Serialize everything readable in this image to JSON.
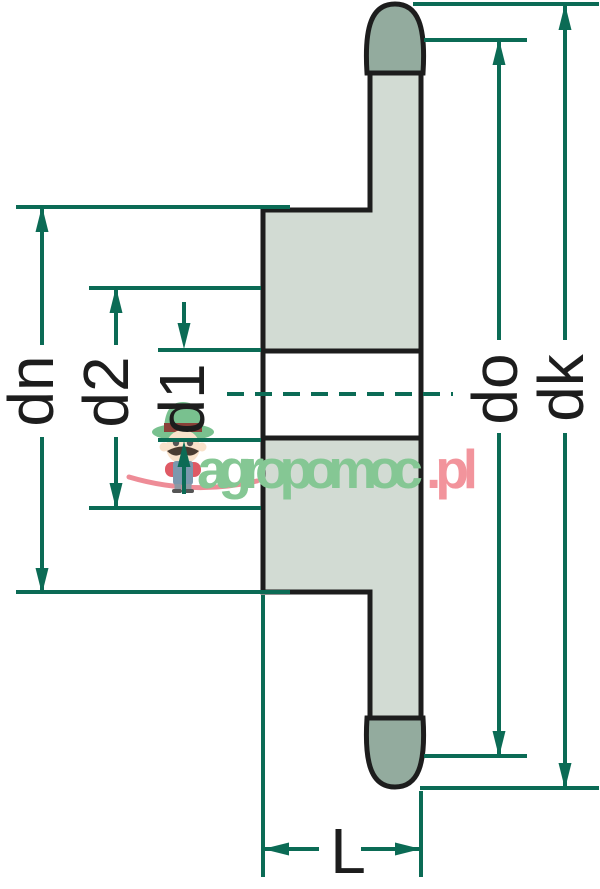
{
  "diagram": {
    "subject": "Sprocket cross-section dimension drawing",
    "dimension_labels": {
      "dn": "dn",
      "d2": "d2",
      "d1": "d1",
      "do": "do",
      "dk": "dk",
      "L": "L"
    },
    "watermark": {
      "brand_green": "agropomoc",
      "brand_pink": ".pl"
    },
    "colors": {
      "dimension_line": "#0b6b55",
      "outline": "#1d1d1d",
      "body_fill": "#d2dbd3",
      "tooth_fill": "#93ab9e",
      "bore_fill": "#ffffff",
      "background": "#ffffff",
      "watermark_green": "#85c794",
      "watermark_pink": "#f2949c",
      "swoosh_pink": "#ee8c97"
    }
  }
}
